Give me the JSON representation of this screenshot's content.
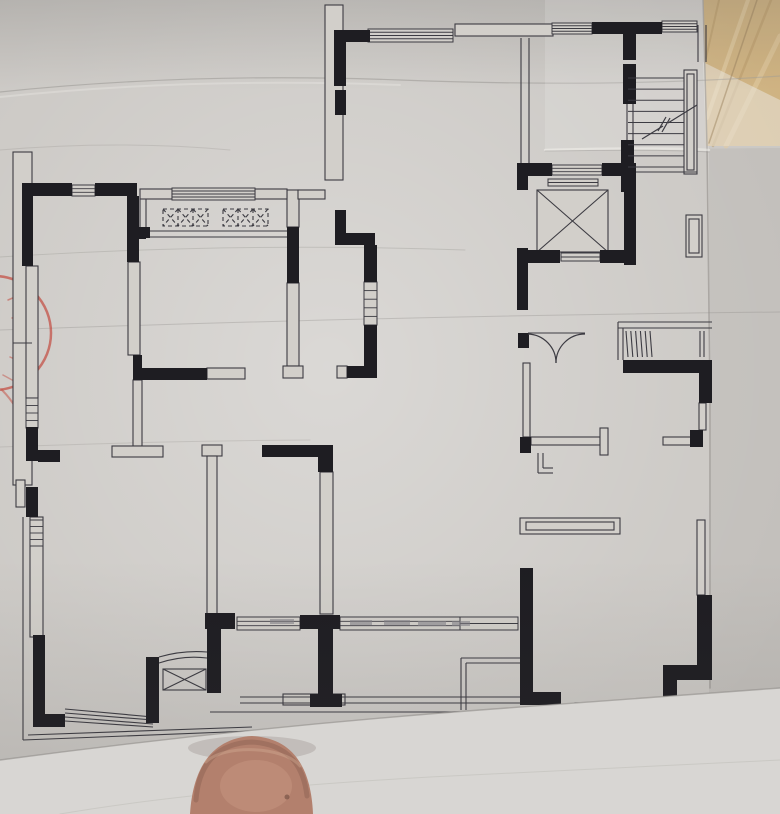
{
  "scene": {
    "bg_right": "#c2bfbb",
    "paper": "#cbc8c4",
    "paper_light": "#d6d4d0",
    "ink": "#1e1d22",
    "line": "#3c3b42",
    "outline_fill": "#d2cfca",
    "sill_gray": "#c6c3be",
    "dash_gray": "#85838a",
    "stamp_red": "#c34a3e",
    "tan": "#c8a76e",
    "tan_light": "#dcc291",
    "tan_dark": "#a8854b",
    "undersheet": "#d8d6d3",
    "skin": "#b3806d",
    "skin_dark": "#8a5f50",
    "skin_light": "#d4a78f"
  },
  "floor_plan": {
    "black_walls": [
      [
        22,
        183,
        50,
        13
      ],
      [
        95,
        183,
        42,
        13
      ],
      [
        22,
        196,
        11,
        70
      ],
      [
        127,
        196,
        12,
        66
      ],
      [
        137,
        228,
        9,
        11
      ],
      [
        130,
        227,
        20,
        11
      ],
      [
        287,
        227,
        12,
        56
      ],
      [
        26,
        427,
        12,
        34
      ],
      [
        38,
        450,
        22,
        12
      ],
      [
        26,
        487,
        12,
        30
      ],
      [
        33,
        635,
        12,
        92
      ],
      [
        33,
        714,
        32,
        13
      ],
      [
        133,
        355,
        9,
        23
      ],
      [
        133,
        368,
        74,
        12
      ],
      [
        335,
        30,
        35,
        12
      ],
      [
        334,
        30,
        12,
        56
      ],
      [
        335,
        90,
        11,
        25
      ],
      [
        335,
        210,
        11,
        35
      ],
      [
        335,
        233,
        40,
        12
      ],
      [
        364,
        245,
        13,
        37
      ],
      [
        364,
        325,
        13,
        43
      ],
      [
        347,
        366,
        30,
        12
      ],
      [
        262,
        445,
        62,
        12
      ],
      [
        318,
        445,
        15,
        27
      ],
      [
        205,
        613,
        30,
        16
      ],
      [
        207,
        629,
        14,
        64
      ],
      [
        300,
        615,
        40,
        14
      ],
      [
        318,
        629,
        15,
        66
      ],
      [
        310,
        694,
        32,
        13
      ],
      [
        517,
        163,
        35,
        13
      ],
      [
        602,
        163,
        34,
        13
      ],
      [
        624,
        163,
        12,
        102
      ],
      [
        517,
        176,
        11,
        14
      ],
      [
        517,
        248,
        11,
        62
      ],
      [
        527,
        250,
        33,
        13
      ],
      [
        600,
        250,
        36,
        13
      ],
      [
        518,
        333,
        11,
        15
      ],
      [
        592,
        22,
        70,
        12
      ],
      [
        623,
        34,
        13,
        26
      ],
      [
        623,
        64,
        13,
        40
      ],
      [
        621,
        140,
        13,
        52
      ],
      [
        623,
        360,
        89,
        13
      ],
      [
        699,
        373,
        13,
        30
      ],
      [
        690,
        430,
        13,
        17
      ],
      [
        520,
        437,
        11,
        16
      ],
      [
        520,
        568,
        13,
        137
      ],
      [
        533,
        692,
        28,
        13
      ],
      [
        697,
        595,
        15,
        73
      ],
      [
        663,
        665,
        49,
        15
      ],
      [
        663,
        680,
        14,
        32
      ],
      [
        146,
        657,
        13,
        66
      ]
    ],
    "outlines": [
      [
        325,
        5,
        18,
        175
      ],
      [
        13,
        152,
        19,
        333
      ],
      [
        16,
        480,
        9,
        27
      ],
      [
        26,
        266,
        12,
        132
      ],
      [
        30,
        517,
        13,
        120
      ],
      [
        128,
        262,
        12,
        93
      ],
      [
        133,
        380,
        9,
        66
      ],
      [
        112,
        446,
        51,
        11
      ],
      [
        202,
        445,
        20,
        11
      ],
      [
        207,
        456,
        10,
        158
      ],
      [
        287,
        190,
        12,
        37
      ],
      [
        287,
        283,
        12,
        83
      ],
      [
        283,
        366,
        20,
        12
      ],
      [
        337,
        366,
        10,
        12
      ],
      [
        320,
        472,
        13,
        142
      ],
      [
        455,
        24,
        98,
        12
      ],
      [
        140,
        189,
        32,
        10
      ],
      [
        255,
        189,
        32,
        10
      ],
      [
        298,
        190,
        27,
        9
      ],
      [
        523,
        363,
        7,
        74
      ],
      [
        531,
        437,
        69,
        8
      ],
      [
        600,
        428,
        8,
        27
      ],
      [
        663,
        437,
        37,
        8
      ],
      [
        699,
        403,
        7,
        27
      ],
      [
        697,
        520,
        8,
        75
      ],
      [
        520,
        518,
        100,
        16
      ],
      [
        526,
        522,
        88,
        8
      ],
      [
        283,
        694,
        62,
        11
      ],
      [
        684,
        70,
        13,
        104
      ],
      [
        687,
        74,
        7,
        96
      ],
      [
        686,
        215,
        16,
        42
      ],
      [
        689,
        219,
        10,
        34
      ],
      [
        207,
        368,
        38,
        11
      ],
      [
        537,
        190,
        71,
        62
      ]
    ],
    "windows": [
      [
        72,
        185,
        23,
        11,
        2
      ],
      [
        172,
        188,
        83,
        12,
        3
      ],
      [
        368,
        29,
        85,
        13,
        3
      ],
      [
        552,
        23,
        40,
        11,
        3
      ],
      [
        662,
        21,
        35,
        11,
        3
      ],
      [
        26,
        398,
        12,
        30,
        3
      ],
      [
        30,
        520,
        13,
        26,
        3
      ],
      [
        364,
        282,
        13,
        43,
        4
      ],
      [
        552,
        165,
        50,
        10,
        2
      ],
      [
        548,
        179,
        50,
        7,
        1
      ],
      [
        561,
        253,
        39,
        8,
        1
      ],
      [
        237,
        617,
        63,
        13,
        2
      ],
      [
        340,
        617,
        120,
        13,
        2
      ],
      [
        460,
        617,
        58,
        13,
        1
      ]
    ],
    "sill_band": [
      575,
      703,
      80,
      9
    ],
    "lines": [
      [
        521,
        38,
        521,
        163
      ],
      [
        529,
        38,
        529,
        163
      ],
      [
        698,
        25,
        698,
        62
      ],
      [
        706,
        25,
        706,
        62
      ],
      [
        618,
        322,
        712,
        322
      ],
      [
        618,
        328,
        712,
        328
      ],
      [
        618,
        322,
        618,
        360
      ],
      [
        623,
        328,
        623,
        360
      ],
      [
        528,
        333,
        585,
        333
      ],
      [
        146,
        231,
        287,
        231
      ],
      [
        146,
        237,
        287,
        237
      ],
      [
        628,
        172,
        697,
        172
      ],
      [
        13,
        343,
        32,
        343
      ],
      [
        23,
        517,
        23,
        740
      ],
      [
        23,
        740,
        252,
        731
      ],
      [
        28,
        735,
        252,
        727
      ],
      [
        210,
        712,
        560,
        712
      ],
      [
        240,
        697,
        520,
        697
      ],
      [
        240,
        703,
        520,
        703
      ],
      [
        560,
        713,
        700,
        713
      ],
      [
        65,
        709,
        153,
        717
      ],
      [
        65,
        713,
        153,
        720
      ],
      [
        65,
        717,
        153,
        724
      ],
      [
        65,
        721,
        153,
        727
      ],
      [
        461,
        658,
        520,
        658
      ],
      [
        466,
        663,
        520,
        663
      ],
      [
        461,
        658,
        461,
        710
      ],
      [
        466,
        663,
        466,
        710
      ],
      [
        700,
        331,
        700,
        357
      ],
      [
        704,
        331,
        704,
        357
      ],
      [
        537,
        190,
        608,
        252
      ],
      [
        608,
        190,
        537,
        252
      ],
      [
        627,
        104,
        627,
        140
      ],
      [
        633,
        104,
        633,
        140
      ],
      [
        140,
        199,
        140,
        231
      ],
      [
        146,
        199,
        146,
        231
      ],
      [
        538,
        453,
        538,
        473
      ],
      [
        538,
        473,
        553,
        473
      ],
      [
        543,
        453,
        543,
        468
      ],
      [
        543,
        468,
        553,
        468
      ]
    ],
    "paths": [
      [
        "M159,663 Q183,655 207,658",
        1.1
      ],
      [
        "M159,657 Q183,650 207,652",
        1.1
      ],
      [
        "M642,139 L663,126",
        1.2
      ],
      [
        "M668,123 L697,105",
        1.2
      ],
      [
        "M658,131 L666,117",
        1.2
      ],
      [
        "M662,132 L670,118",
        1.2
      ]
    ],
    "door_arcs": [
      "M528,334 A29,29 0 0 1 556,363",
      "M585,334 A29,29 0 0 0 556,363"
    ],
    "stair": {
      "x1": 628,
      "x2": 684,
      "y1": 78,
      "y2": 167,
      "n": 9
    },
    "x_boxes": [
      [
        163,
        209,
        45,
        17,
        3,
        1
      ],
      [
        223,
        209,
        45,
        17,
        3,
        1
      ],
      [
        163,
        669,
        43,
        21,
        1,
        0
      ]
    ],
    "louver": [
      626,
      331,
      24,
      26,
      6
    ],
    "gray_dashes": [
      [
        270,
        619,
        24,
        5
      ],
      [
        350,
        620,
        22,
        5
      ],
      [
        384,
        620,
        26,
        5
      ],
      [
        418,
        621,
        28,
        5
      ],
      [
        452,
        621,
        18,
        5
      ]
    ]
  },
  "photo": {
    "tan_corner": [
      {
        "t": "poly",
        "p": "703,0 780,0 780,146 706,146",
        "f": "#c8a76e",
        "o": 1
      },
      {
        "t": "path",
        "d": "M719,0 L706,58",
        "s": "#a8854b",
        "w": 2,
        "o": 0.5
      },
      {
        "t": "path",
        "d": "M748,0 L707,118",
        "s": "#dcc291",
        "w": 4,
        "o": 0.7
      },
      {
        "t": "path",
        "d": "M771,0 L713,146",
        "s": "#a8854b",
        "w": 2.5,
        "o": 0.45
      },
      {
        "t": "path",
        "d": "M780,36 L726,146",
        "s": "#dcc291",
        "w": 5,
        "o": 0.6
      },
      {
        "t": "poly",
        "p": "703,62 780,100 780,146 706,146",
        "f": "#e8e5df",
        "o": 0.5
      },
      {
        "t": "path",
        "d": "M757,0 L709,143",
        "s": "#8a6c42",
        "w": 1.5,
        "o": 0.5
      }
    ],
    "paper_edge": [
      {
        "t": "path",
        "d": "M703,0 L707,146 L710,400 L710,688",
        "s": "#9c9995",
        "w": 1.5,
        "o": 0.8
      }
    ],
    "creases": [
      {
        "t": "path",
        "d": "M0,92 Q190,72 400,80 Q610,88 780,76",
        "s": "#8e8b87",
        "w": 1.2,
        "o": 0.45
      },
      {
        "t": "path",
        "d": "M0,97 Q190,77 400,85",
        "s": "#e4e2de",
        "w": 2,
        "o": 0.5
      },
      {
        "t": "path",
        "d": "M0,150 Q120,140 230,150",
        "s": "#908d89",
        "w": 1,
        "o": 0.25
      },
      {
        "t": "path",
        "d": "M0,257 Q230,242 465,250",
        "s": "#908d89",
        "w": 1,
        "o": 0.3
      },
      {
        "t": "path",
        "d": "M0,330 Q390,316 780,312",
        "s": "#908d89",
        "w": 1,
        "o": 0.35
      },
      {
        "t": "path",
        "d": "M0,447 Q160,441 310,440",
        "s": "#908d89",
        "w": 1,
        "o": 0.25
      },
      {
        "t": "poly",
        "p": "545,0 780,0 780,148 545,150",
        "f": "#ffffff",
        "o": 0.14
      },
      {
        "t": "path",
        "d": "M545,150 Q660,147 709,150",
        "s": "#f0eeea",
        "w": 2.5,
        "o": 0.6
      },
      {
        "t": "path",
        "d": "M545,151 Q660,149 709,152",
        "s": "#969390",
        "w": 1,
        "o": 0.4
      }
    ],
    "stamp": [
      {
        "t": "circle",
        "cx": -6,
        "cy": 333,
        "r": 57,
        "s": "#c34a3e",
        "w": 2.5,
        "o": 0.7
      },
      {
        "t": "path",
        "d": "M8,300 l7,-3",
        "s": "#c34a3e",
        "w": 1.5,
        "o": 0.55
      },
      {
        "t": "path",
        "d": "M12,318 l9,-2",
        "s": "#c34a3e",
        "w": 1.5,
        "o": 0.5
      },
      {
        "t": "path",
        "d": "M14,338 l9,1",
        "s": "#c34a3e",
        "w": 1.5,
        "o": 0.5
      },
      {
        "t": "path",
        "d": "M10,357 l9,4",
        "s": "#c34a3e",
        "w": 1.5,
        "o": 0.5
      },
      {
        "t": "path",
        "d": "M3,375 l11,6",
        "s": "#c34a3e",
        "w": 1.5,
        "o": 0.45
      },
      {
        "t": "path",
        "d": "M2,390 Q10,398 16,408",
        "s": "#c34a3e",
        "w": 2,
        "o": 0.5
      }
    ],
    "undersheet": [
      {
        "t": "path",
        "d": "M0,764 Q240,732 480,714 Q640,702 780,692",
        "s": "#6b6864",
        "w": 5,
        "o": 0.12
      },
      {
        "t": "poly_path",
        "d": "M0,760 Q240,728 480,710 Q640,698 780,688 L780,814 L0,814 Z",
        "f": "#d8d6d3",
        "o": 1
      },
      {
        "t": "path",
        "d": "M0,760 Q240,728 480,710 Q640,698 780,688",
        "s": "#8f8c88",
        "w": 1.4,
        "o": 0.6
      },
      {
        "t": "path",
        "d": "M60,814 Q200,790 430,777 Q620,768 780,760",
        "s": "#c2bfbb",
        "w": 1,
        "o": 0.6
      }
    ],
    "finger": [
      {
        "t": "ellipse",
        "cx": 252,
        "cy": 748,
        "rx": 64,
        "ry": 12,
        "f": "#5f5049",
        "o": 0.18
      },
      {
        "t": "poly_path",
        "d": "M190,814 C193,765 214,738 252,736 C292,738 311,766 313,814 Z",
        "f": "#b3806d",
        "o": 1
      },
      {
        "t": "path",
        "d": "M196,800 C199,760 221,743 252,742 C285,744 303,762 307,796",
        "s": "#8a5f50",
        "w": 5,
        "o": 0.45
      },
      {
        "t": "path",
        "d": "M206,762 C224,744 284,746 300,766",
        "s": "#d9b49c",
        "w": 3,
        "o": 0.35
      },
      {
        "t": "ellipse",
        "cx": 256,
        "cy": 786,
        "rx": 36,
        "ry": 26,
        "f": "#d4a78f",
        "o": 0.3
      },
      {
        "t": "circle",
        "cx": 287,
        "cy": 797,
        "r": 2.5,
        "f": "#5e3d34",
        "o": 0.5
      }
    ]
  }
}
